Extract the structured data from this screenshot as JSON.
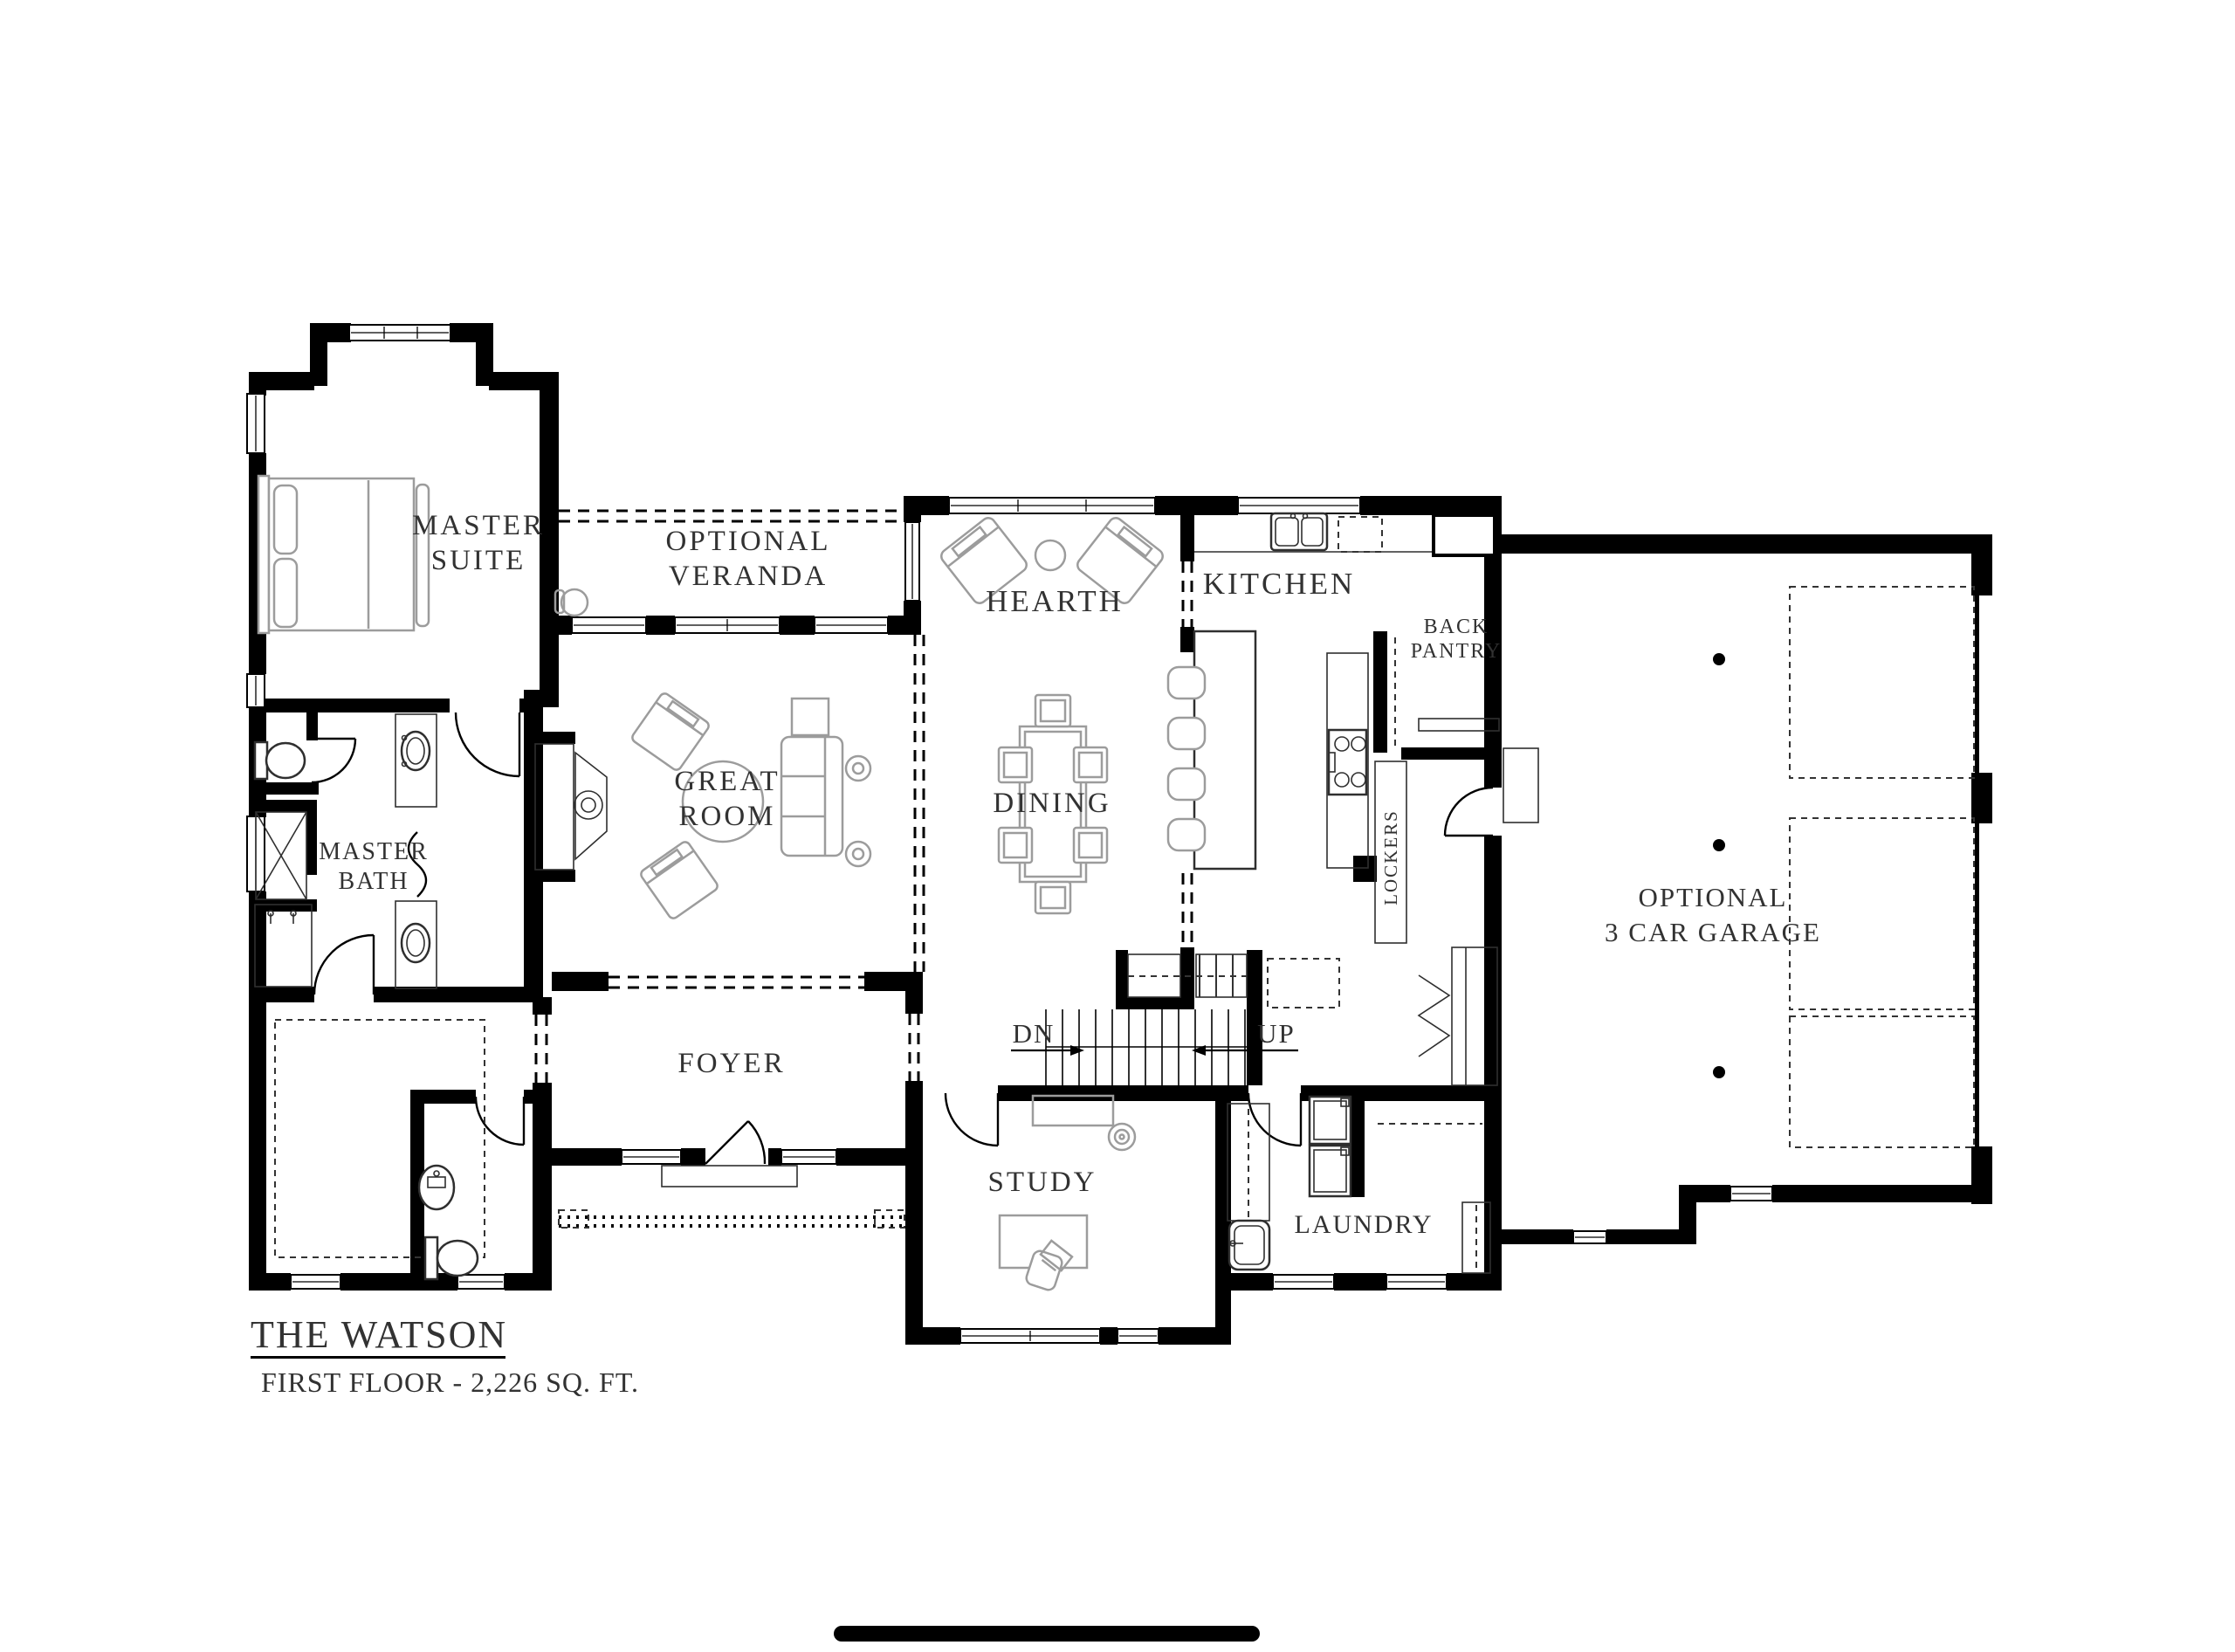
{
  "plan": {
    "name": "THE WATSON",
    "floor_info": "FIRST FLOOR - 2,226 SQ. FT.",
    "labels": {
      "master_suite": [
        "MASTER",
        "SUITE"
      ],
      "veranda": [
        "OPTIONAL",
        "VERANDA"
      ],
      "great_room": [
        "GREAT",
        "ROOM"
      ],
      "hearth": "HEARTH",
      "dining": "DINING",
      "kitchen": "KITCHEN",
      "back_pantry": [
        "BACK",
        "PANTRY"
      ],
      "lockers": "LOCKERS",
      "master_bath": [
        "MASTER",
        "BATH"
      ],
      "foyer": "FOYER",
      "study": "STUDY",
      "laundry": "LAUNDRY",
      "garage": [
        "OPTIONAL",
        "3 CAR GARAGE"
      ],
      "stairs_down": "DN",
      "stairs_up": "UP"
    },
    "colors": {
      "walls": "#000000",
      "fixtures": "#2f2f2f",
      "furniture": "#9c9c9c",
      "text": "#323232",
      "background": "#ffffff"
    }
  }
}
